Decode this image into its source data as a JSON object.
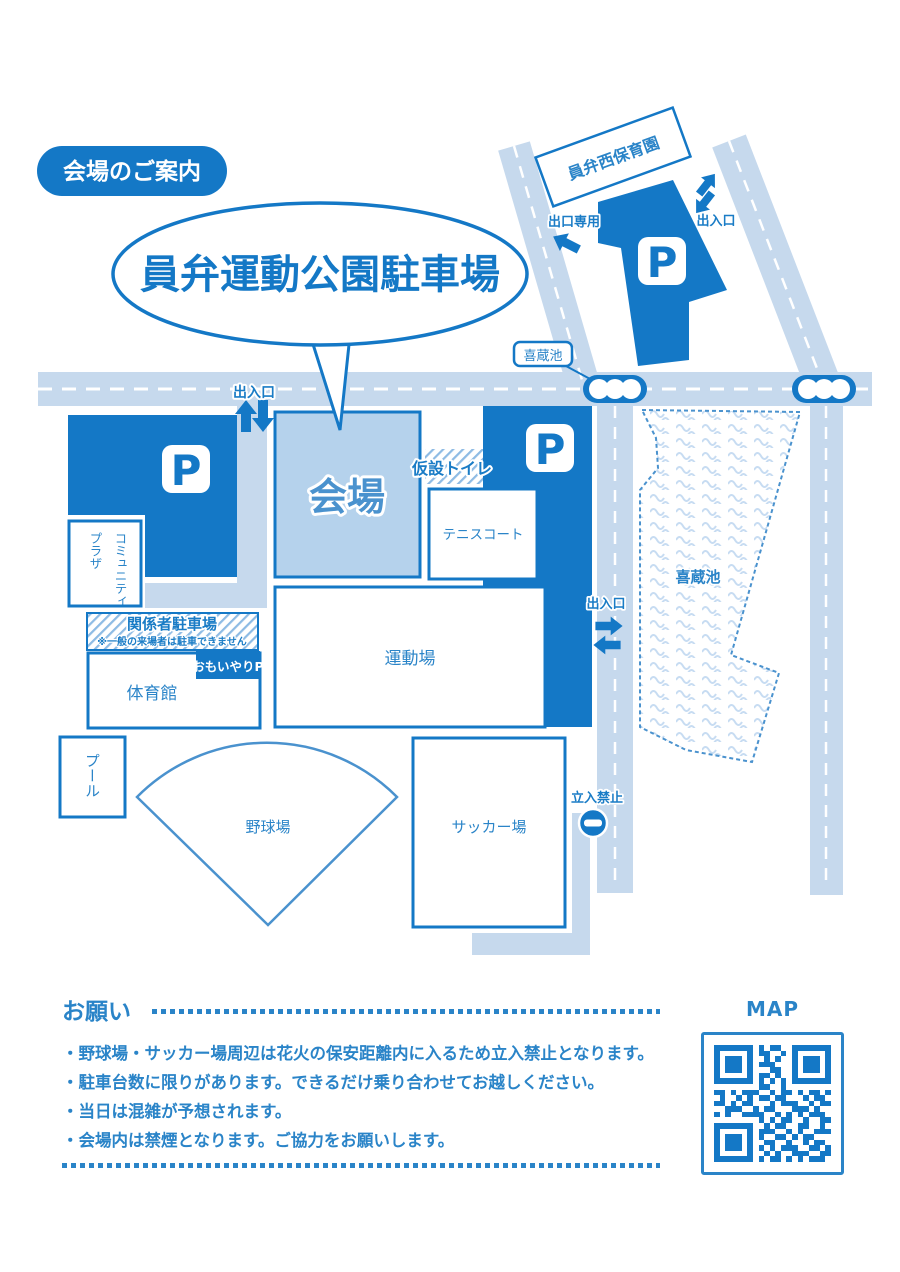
{
  "page": {
    "badge": "会場のご案内",
    "bubble_title": "員弁運動公園駐車場"
  },
  "map": {
    "labels": {
      "nursery": "員弁西保育園",
      "exit_only": "出口専用",
      "gate": "出入口",
      "kizo_pond": "喜蔵池",
      "venue": "会場",
      "temp_toilet": "仮設トイレ",
      "tennis_court": "テニスコート",
      "community_plaza_line1": "コミュニティ",
      "community_plaza_line2": "プラザ",
      "staff_parking": "関係者駐車場",
      "staff_parking_note": "※一般の来場者は駐車できません",
      "omoiyari_parking": "おもいやりP",
      "gym": "体育館",
      "sports_field": "運動場",
      "pool": "プール",
      "baseball_field": "野球場",
      "soccer_field": "サッカー場",
      "no_entry": "立入禁止",
      "parking_symbol": "P"
    }
  },
  "notes": {
    "heading": "お願い",
    "items": [
      "・野球場・サッカー場周辺は花火の保安距離内に入るため立入禁止となります。",
      "・駐車台数に限りがあります。できるだけ乗り合わせてお越しください。",
      "・当日は混雑が予想されます。",
      "・会場内は禁煙となります。ご協力をお願いします。"
    ]
  },
  "qr_section": {
    "label": "MAP",
    "matrix": [
      "111111101011001111111",
      "100000101100101000001",
      "101110100101001011101",
      "101110101110001011101",
      "101110100011001011101",
      "100000101101001000001",
      "111111101010101111111",
      "000000001100100000000",
      "110101110010110101101",
      "010010101101100010110",
      "110101100010111001011",
      "001110010110001110100",
      "101001111001010101110",
      "000000001010110010011",
      "111111100101100110010",
      "100000101110010100111",
      "101110101001101011000",
      "101110100110010010110",
      "101110101010111001101",
      "100000100101001110011",
      "111111101011010101110"
    ]
  },
  "colors": {
    "primary": "#1478c6",
    "label_blue": "#2a84c8",
    "road": "#c6d9ed",
    "venue_fill": "#b5d2ec"
  }
}
